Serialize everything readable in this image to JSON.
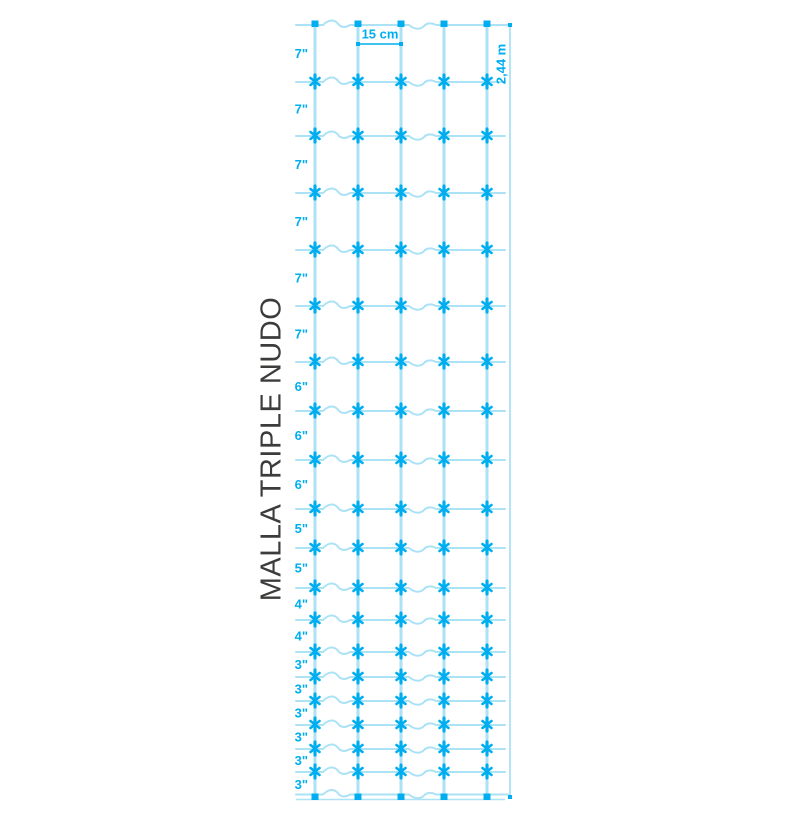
{
  "title": "MALLA TRIPLE NUDO",
  "dimensions": {
    "cell_width_label": "15 cm",
    "total_height_label": "2,44 m"
  },
  "row_spacing_labels": [
    "7\"",
    "7\"",
    "7\"",
    "7\"",
    "7\"",
    "7\"",
    "6\"",
    "6\"",
    "6\"",
    "5\"",
    "5\"",
    "4\"",
    "4\"",
    "3\"",
    "3\"",
    "3\"",
    "3\"",
    "3\"",
    "3\""
  ],
  "mesh": {
    "vertical_wires_x": [
      315,
      358,
      401,
      444,
      487
    ],
    "horizontal_wires_y": [
      25,
      82,
      136,
      193,
      250,
      306,
      362,
      411,
      460,
      509,
      548,
      588,
      620,
      652,
      677,
      701,
      725,
      749,
      772,
      797
    ],
    "wire_left_x": 296,
    "wire_right_x": 505,
    "dimension_line_x": 510,
    "cell_dimension": {
      "from_x": 358,
      "to_x": 401,
      "line_y": 44
    },
    "row_label_right_x": 308
  },
  "colors": {
    "wire": "#ace2f5",
    "accent": "#00aeef",
    "title_text": "#3c3c3b",
    "background": "#ffffff"
  }
}
